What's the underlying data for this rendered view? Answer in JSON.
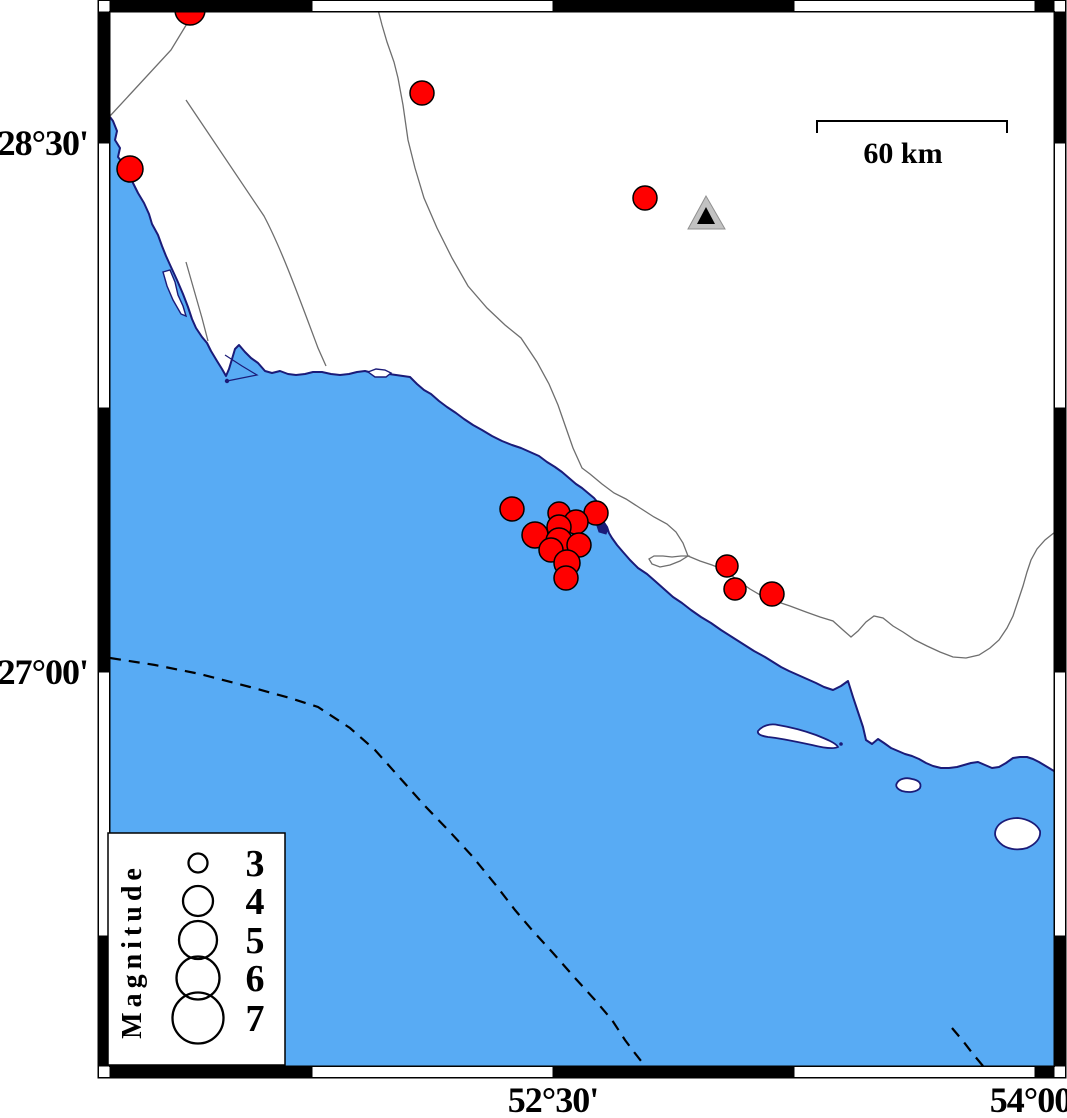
{
  "colors": {
    "sea": "#58abf4",
    "land": "#ffffff",
    "coast": "#1b1b78",
    "border_line": "#6e6e6e",
    "dashed_boundary": "#000000",
    "quake_fill": "#ff0000",
    "quake_stroke": "#000000",
    "triangle_outer": "#c2c2c2",
    "triangle_outer_edge": "#909090",
    "triangle_inner": "#000000",
    "frame_dark": "#000000",
    "frame_light": "#ffffff"
  },
  "axis_labels": [
    {
      "id": "lat-28-30",
      "text": "28°30'",
      "x": 88,
      "y": 155,
      "anchor": "end",
      "size": 36
    },
    {
      "id": "lat-27-00",
      "text": "27°00'",
      "x": 88,
      "y": 684,
      "anchor": "end",
      "size": 36
    },
    {
      "id": "lon-52-30",
      "text": "52°30'",
      "x": 553,
      "y": 1112,
      "anchor": "middle",
      "size": 36
    },
    {
      "id": "lon-54-00",
      "text": "54°00'",
      "x": 1035,
      "y": 1112,
      "anchor": "middle",
      "size": 36
    }
  ],
  "scale_bar": {
    "label": "60 km",
    "x1": 817,
    "x2": 1007,
    "y": 121,
    "tick_drop": 12,
    "label_x": 903,
    "label_y": 163,
    "label_size": 30
  },
  "legend": {
    "title": "Magnitude",
    "box": {
      "x": 108,
      "y": 833,
      "w": 177,
      "h": 232
    },
    "symbol_x": 198,
    "label_x": 255,
    "title_x": 141,
    "title_y": 951,
    "items": [
      {
        "label": "3",
        "cy": 863,
        "r": 9.5
      },
      {
        "label": "4",
        "cy": 901,
        "r": 15
      },
      {
        "label": "5",
        "cy": 940,
        "r": 19
      },
      {
        "label": "6",
        "cy": 978,
        "r": 21.5
      },
      {
        "label": "7",
        "cy": 1018,
        "r": 25.5
      }
    ]
  },
  "station_marker": {
    "outer": "706,196 688,229 725,229",
    "inner": "706,207 697,224 715,224"
  },
  "earthquakes": [
    {
      "x": 190,
      "y": 10,
      "r": 15
    },
    {
      "x": 422,
      "y": 93,
      "r": 12
    },
    {
      "x": 130,
      "y": 169,
      "r": 13
    },
    {
      "x": 645,
      "y": 198,
      "r": 12
    },
    {
      "x": 512,
      "y": 509,
      "r": 12
    },
    {
      "x": 559,
      "y": 513,
      "r": 11
    },
    {
      "x": 596,
      "y": 513,
      "r": 12
    },
    {
      "x": 576,
      "y": 522,
      "r": 12
    },
    {
      "x": 559,
      "y": 527,
      "r": 12
    },
    {
      "x": 535,
      "y": 535,
      "r": 13
    },
    {
      "x": 559,
      "y": 541,
      "r": 13
    },
    {
      "x": 579,
      "y": 545,
      "r": 12
    },
    {
      "x": 551,
      "y": 550,
      "r": 12
    },
    {
      "x": 567,
      "y": 563,
      "r": 13
    },
    {
      "x": 566,
      "y": 578,
      "r": 12
    },
    {
      "x": 727,
      "y": 566,
      "r": 11
    },
    {
      "x": 735,
      "y": 589,
      "r": 11
    },
    {
      "x": 772,
      "y": 594,
      "r": 12
    }
  ],
  "frame": {
    "outer": {
      "x": 98,
      "y": 0,
      "w": 968,
      "h": 1078
    },
    "band": 12,
    "x_transitions": [
      312,
      553,
      794,
      1035
    ],
    "y_transitions": [
      143,
      408,
      672,
      936
    ]
  }
}
